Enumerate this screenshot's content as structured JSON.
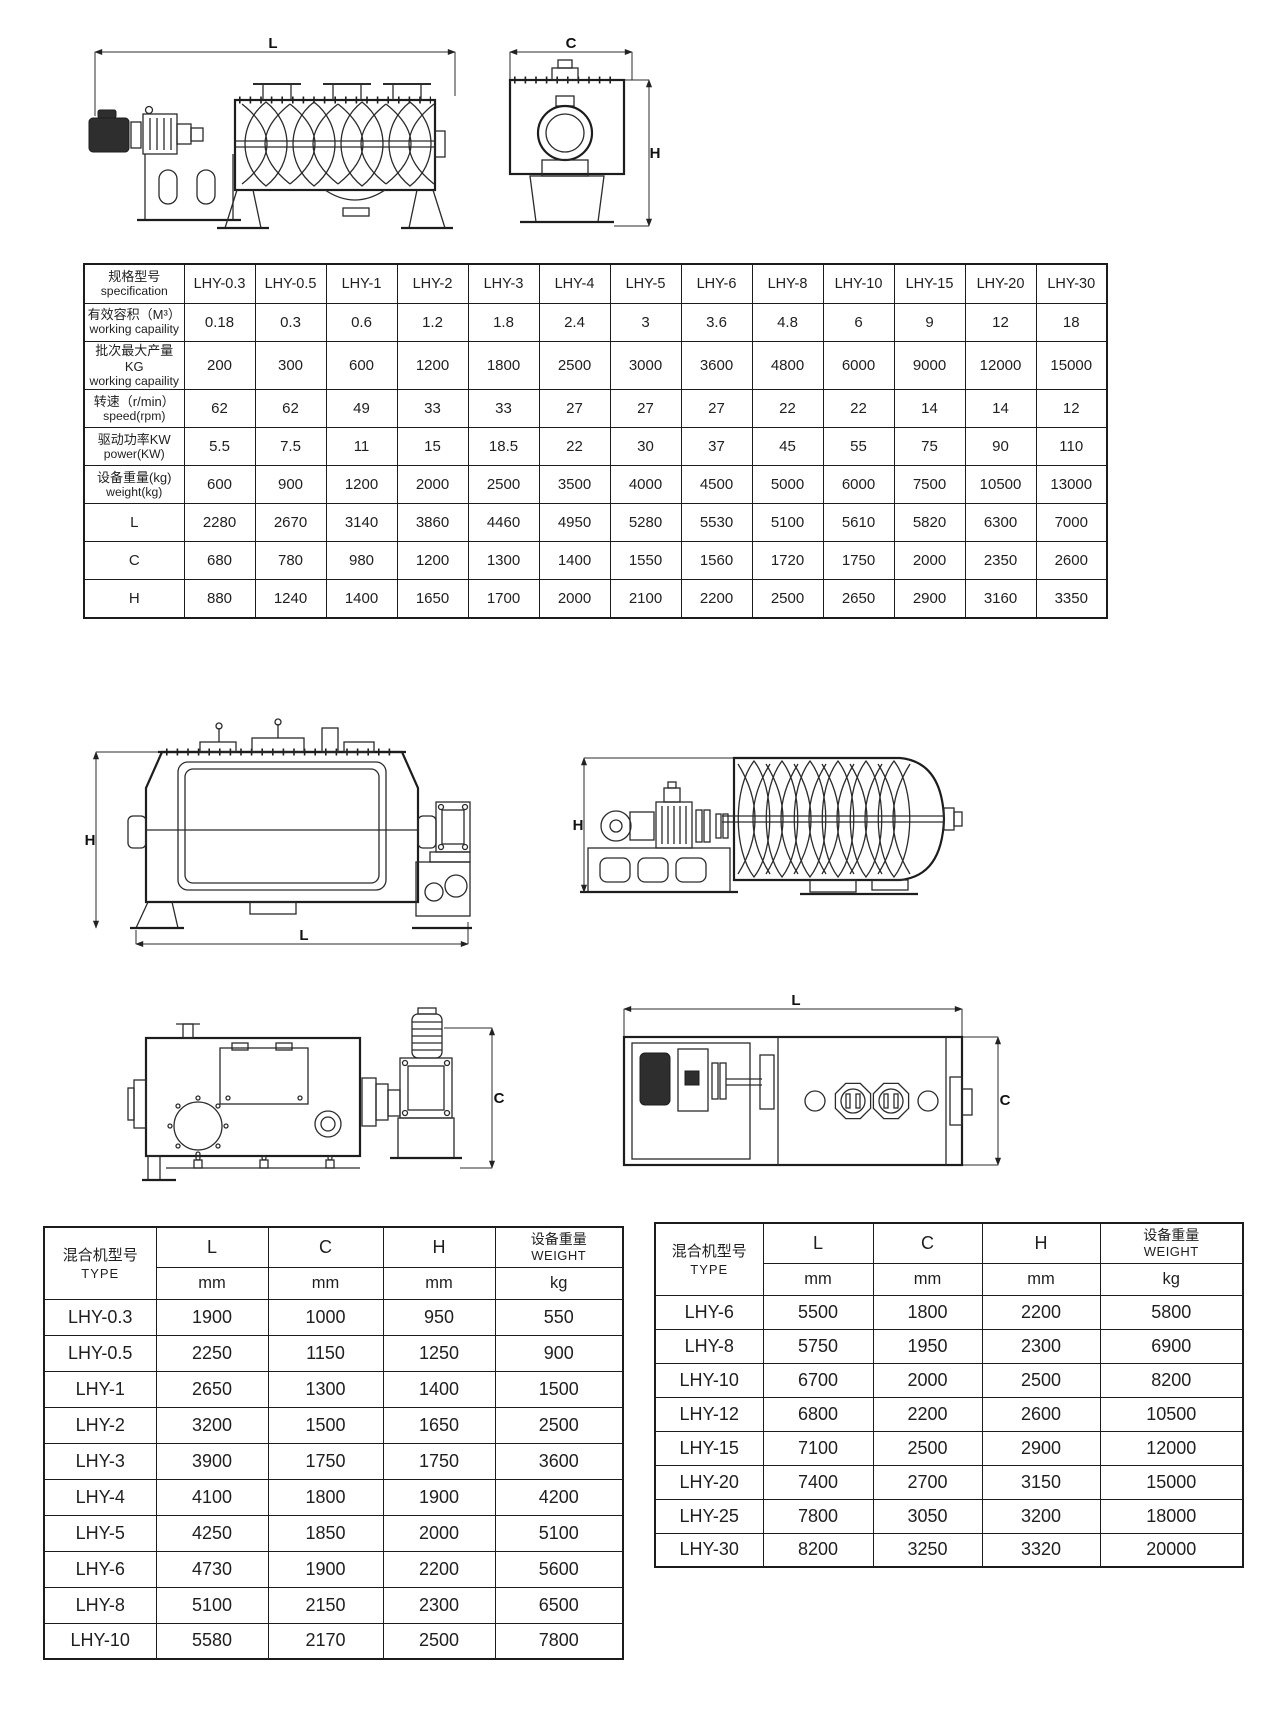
{
  "drawings": {
    "top_side_view": {
      "dim_length": "L"
    },
    "top_end_view": {
      "dim_width": "C",
      "dim_height": "H"
    },
    "mid_front_view": {
      "dim_height": "H",
      "dim_length": "L"
    },
    "mid_side_view": {
      "dim_height": "H"
    },
    "low_side_view": {
      "dim_width": "C"
    },
    "low_plan_view": {
      "dim_length": "L",
      "dim_width": "C"
    }
  },
  "spec_table": {
    "corner": {
      "cn": "规格型号",
      "en": "specification"
    },
    "models": [
      "LHY-0.3",
      "LHY-0.5",
      "LHY-1",
      "LHY-2",
      "LHY-3",
      "LHY-4",
      "LHY-5",
      "LHY-6",
      "LHY-8",
      "LHY-10",
      "LHY-15",
      "LHY-20",
      "LHY-30"
    ],
    "rows": [
      {
        "cn": "有效容积（M³）",
        "en": "working capaility",
        "values": [
          "0.18",
          "0.3",
          "0.6",
          "1.2",
          "1.8",
          "2.4",
          "3",
          "3.6",
          "4.8",
          "6",
          "9",
          "12",
          "18"
        ]
      },
      {
        "cn": "批次最大产量KG",
        "en": "working capaility",
        "values": [
          "200",
          "300",
          "600",
          "1200",
          "1800",
          "2500",
          "3000",
          "3600",
          "4800",
          "6000",
          "9000",
          "12000",
          "15000"
        ]
      },
      {
        "cn": "转速（r/min）",
        "en": "speed(rpm)",
        "values": [
          "62",
          "62",
          "49",
          "33",
          "33",
          "27",
          "27",
          "27",
          "22",
          "22",
          "14",
          "14",
          "12"
        ]
      },
      {
        "cn": "驱动功率KW",
        "en": "power(KW)",
        "values": [
          "5.5",
          "7.5",
          "11",
          "15",
          "18.5",
          "22",
          "30",
          "37",
          "45",
          "55",
          "75",
          "90",
          "110"
        ]
      },
      {
        "cn": "设备重量(kg)",
        "en": "weight(kg)",
        "values": [
          "600",
          "900",
          "1200",
          "2000",
          "2500",
          "3500",
          "4000",
          "4500",
          "5000",
          "6000",
          "7500",
          "10500",
          "13000"
        ]
      },
      {
        "cn": "L",
        "en": "",
        "values": [
          "2280",
          "2670",
          "3140",
          "3860",
          "4460",
          "4950",
          "5280",
          "5530",
          "5100",
          "5610",
          "5820",
          "6300",
          "7000"
        ]
      },
      {
        "cn": "C",
        "en": "",
        "values": [
          "680",
          "780",
          "980",
          "1200",
          "1300",
          "1400",
          "1550",
          "1560",
          "1720",
          "1750",
          "2000",
          "2350",
          "2600"
        ]
      },
      {
        "cn": "H",
        "en": "",
        "values": [
          "880",
          "1240",
          "1400",
          "1650",
          "1700",
          "2000",
          "2100",
          "2200",
          "2500",
          "2650",
          "2900",
          "3160",
          "3350"
        ]
      }
    ]
  },
  "dim_table_left": {
    "header": {
      "type_cn": "混合机型号",
      "type_en": "TYPE",
      "l": "L",
      "c": "C",
      "h": "H",
      "weight_cn": "设备重量",
      "weight_en": "WEIGHT",
      "unit_mm": "mm",
      "unit_kg": "kg"
    },
    "rows": [
      [
        "LHY-0.3",
        "1900",
        "1000",
        "950",
        "550"
      ],
      [
        "LHY-0.5",
        "2250",
        "1150",
        "1250",
        "900"
      ],
      [
        "LHY-1",
        "2650",
        "1300",
        "1400",
        "1500"
      ],
      [
        "LHY-2",
        "3200",
        "1500",
        "1650",
        "2500"
      ],
      [
        "LHY-3",
        "3900",
        "1750",
        "1750",
        "3600"
      ],
      [
        "LHY-4",
        "4100",
        "1800",
        "1900",
        "4200"
      ],
      [
        "LHY-5",
        "4250",
        "1850",
        "2000",
        "5100"
      ],
      [
        "LHY-6",
        "4730",
        "1900",
        "2200",
        "5600"
      ],
      [
        "LHY-8",
        "5100",
        "2150",
        "2300",
        "6500"
      ],
      [
        "LHY-10",
        "5580",
        "2170",
        "2500",
        "7800"
      ]
    ]
  },
  "dim_table_right": {
    "header": {
      "type_cn": "混合机型号",
      "type_en": "TYPE",
      "l": "L",
      "c": "C",
      "h": "H",
      "weight_cn": "设备重量",
      "weight_en": "WEIGHT",
      "unit_mm": "mm",
      "unit_kg": "kg"
    },
    "rows": [
      [
        "LHY-6",
        "5500",
        "1800",
        "2200",
        "5800"
      ],
      [
        "LHY-8",
        "5750",
        "1950",
        "2300",
        "6900"
      ],
      [
        "LHY-10",
        "6700",
        "2000",
        "2500",
        "8200"
      ],
      [
        "LHY-12",
        "6800",
        "2200",
        "2600",
        "10500"
      ],
      [
        "LHY-15",
        "7100",
        "2500",
        "2900",
        "12000"
      ],
      [
        "LHY-20",
        "7400",
        "2700",
        "3150",
        "15000"
      ],
      [
        "LHY-25",
        "7800",
        "3050",
        "3200",
        "18000"
      ],
      [
        "LHY-30",
        "8200",
        "3250",
        "3320",
        "20000"
      ]
    ]
  }
}
